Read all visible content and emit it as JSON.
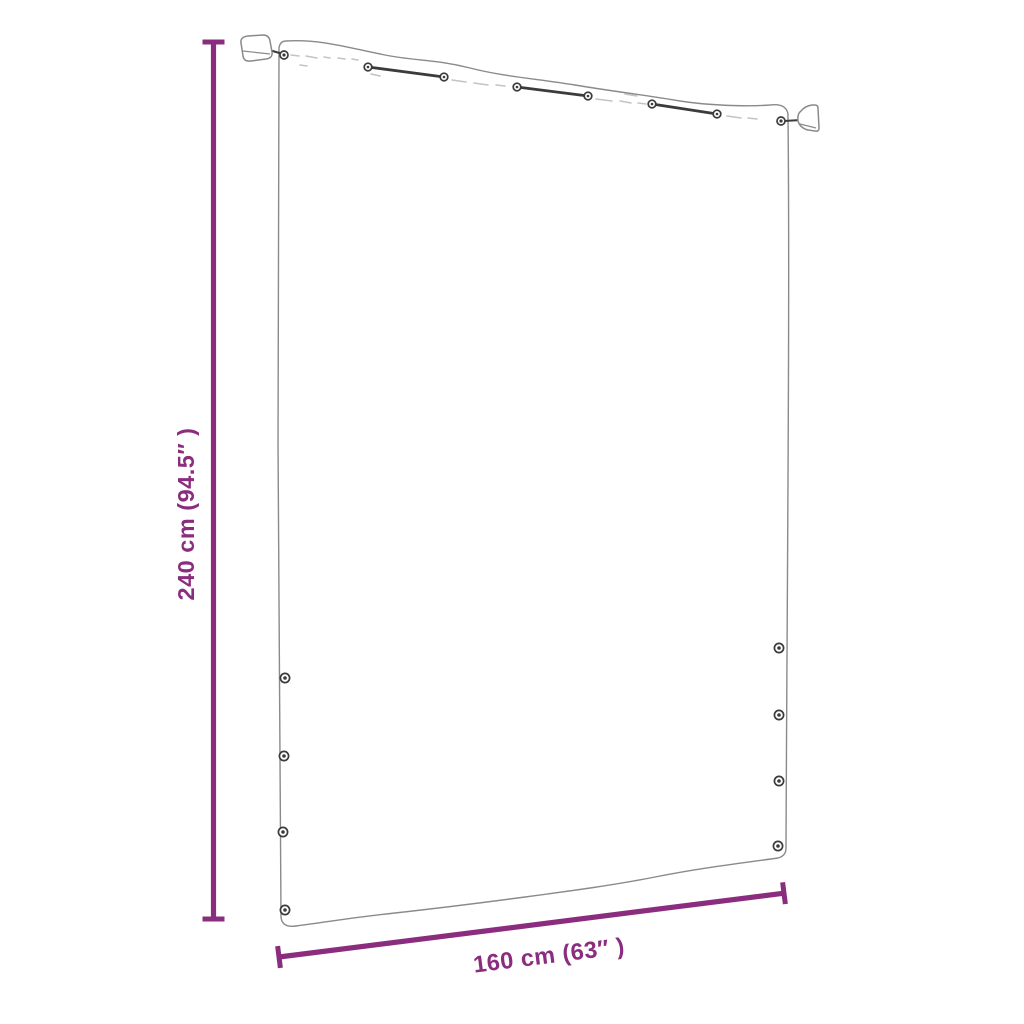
{
  "diagram": {
    "kind": "product-dimension-diagram",
    "dimensions": {
      "height": {
        "label": "240 cm (94.5″ )",
        "value_cm": "240",
        "value_inch": "94.5"
      },
      "width": {
        "label": "160 cm (63″ )",
        "value_cm": "160",
        "value_inch": "63"
      }
    },
    "colors": {
      "dimension": "#8b2d7e",
      "outline": "#8a8a8a",
      "hardware": "#3b3b3b",
      "fold_marks": "#c3c3c3",
      "background": "#ffffff"
    },
    "hardware": {
      "wall_brackets": 2,
      "top_cords": 3,
      "top_grommets": 8,
      "left_side_grommets": 4,
      "right_side_grommets": 4
    }
  }
}
